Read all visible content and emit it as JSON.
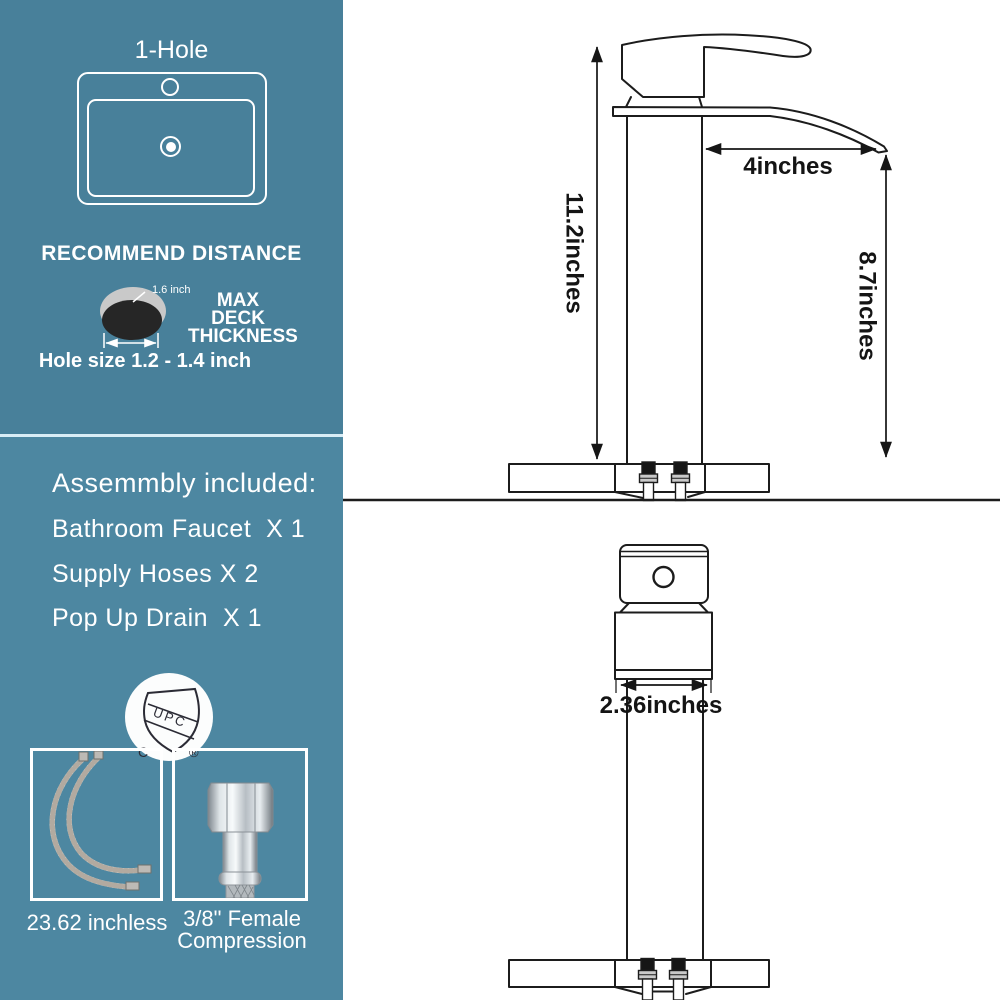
{
  "panel": {
    "colors": {
      "top_bg": "#48809a",
      "bottom_bg": "#4d87a1",
      "text": "#ffffff",
      "drawing_line": "#1c1c1c"
    },
    "hole_config": {
      "title": "1-Hole"
    },
    "recommend": {
      "heading": "RECOMMEND DISTANCE",
      "deck_thickness_value": "1.6 inch",
      "deck_label_line1": "MAX DECK",
      "deck_label_line2": "THICKNESS",
      "hole_size": "Hole size 1.2 - 1.4 inch"
    },
    "assembly": {
      "heading": "Assemmbly included:",
      "items": [
        "Bathroom Faucet  X 1",
        "Supply Hoses X 2",
        "Pop Up Drain  X 1"
      ]
    },
    "certification": {
      "badge_text": "UPC",
      "left_mark": "C",
      "right_mark": "®"
    },
    "parts": {
      "hose_length_label": "23.62 inchless",
      "fitting_label_line1": "3/8\" Female",
      "fitting_label_line2": "Compression"
    }
  },
  "diagram": {
    "dims": {
      "overall_height": "11.2inches",
      "spout_reach": "4inches",
      "spout_height": "8.7inches",
      "body_width": "2.36inches"
    }
  }
}
